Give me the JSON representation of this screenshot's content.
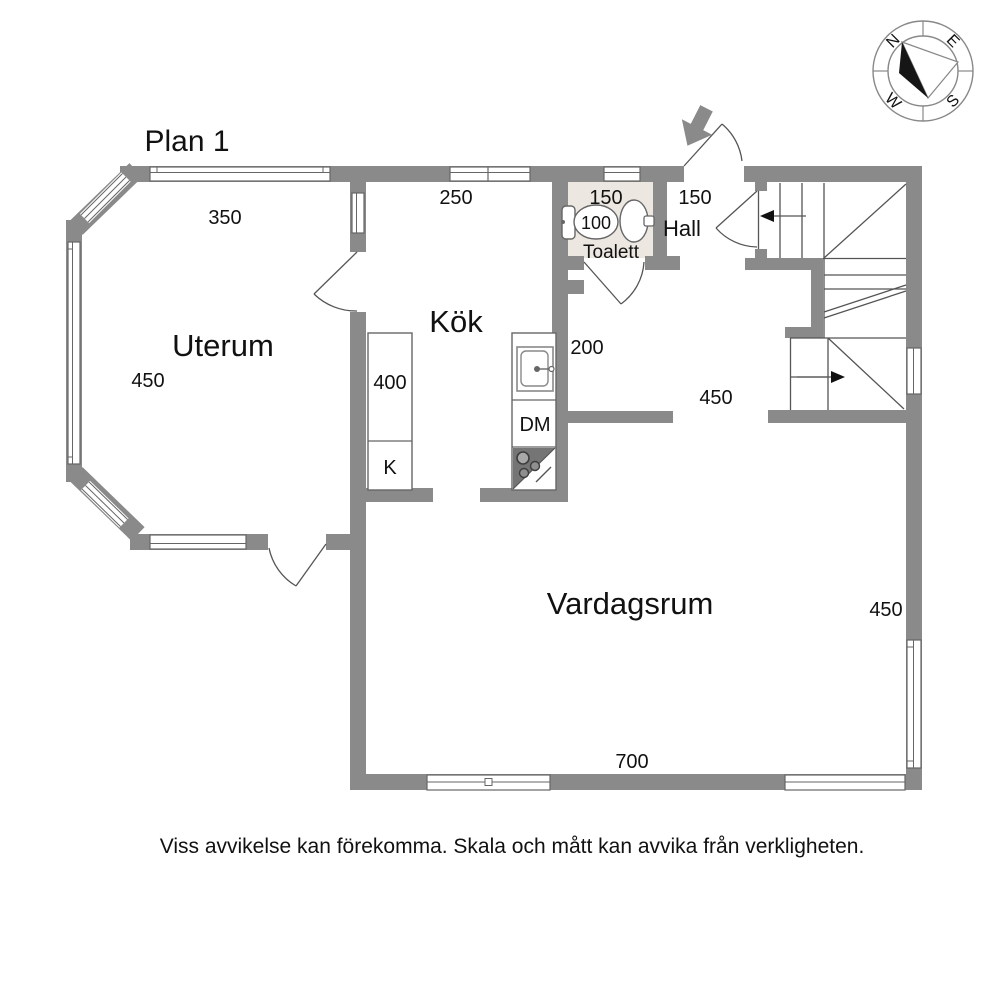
{
  "title": "Plan 1",
  "rooms": {
    "uterum": "Uterum",
    "kok": "Kök",
    "toalett": "Toalett",
    "hall": "Hall",
    "vardagsrum": "Vardagsrum"
  },
  "dimensions": {
    "uterum_top": "350",
    "uterum_left": "450",
    "kok_top": "250",
    "toalett_width": "150",
    "toalett_depth": "100",
    "hall_width": "150",
    "kok_passage": "200",
    "counter_left": "400",
    "corridor": "450",
    "vardagsrum_right": "450",
    "vardagsrum_bottom": "700"
  },
  "fixtures": {
    "fridge": "K",
    "dishwasher": "DM"
  },
  "compass": {
    "north": "N",
    "east": "E",
    "south": "S",
    "west": "W"
  },
  "footer": {
    "disclaimer": "Viss avvikelse kan förekomma. Skala och mått kan avvika från verkligheten."
  },
  "colors": {
    "wall": "#8a8a8a",
    "toilet_floor": "#ece8e1",
    "line": "#555555",
    "stove": "#757575"
  }
}
